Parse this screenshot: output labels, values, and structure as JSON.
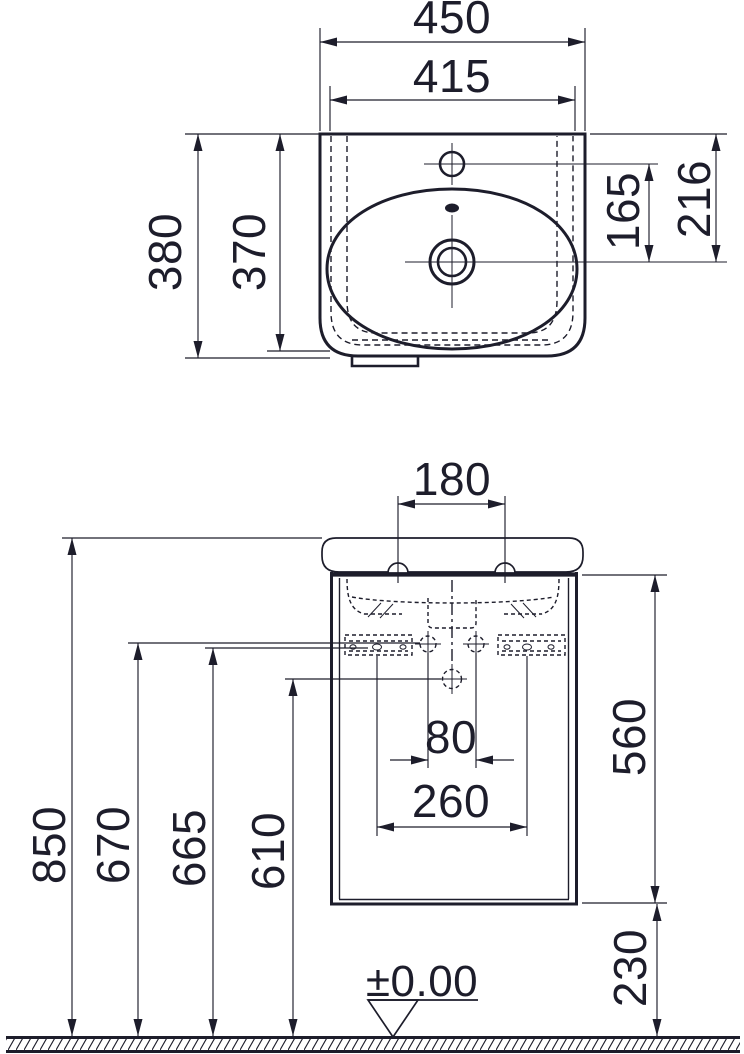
{
  "drawing": {
    "type": "technical-installation-drawing",
    "subject": "wall-hung washbasin with cabinet, plan view and front elevation",
    "line_color": "#1d1d2b",
    "background_color": "#ffffff"
  },
  "top_view": {
    "dims": {
      "overall_width": "450",
      "ledge_width": "415",
      "overall_depth": "380",
      "inner_depth": "370",
      "tap_to_drain": "165",
      "rear_to_drain": "216"
    },
    "features": [
      "basin-outline",
      "hidden-edge-dashed-contours",
      "inner-bowl",
      "tap-hole",
      "overflow-hole",
      "drain-hole",
      "rear-mounting-tab"
    ]
  },
  "front_view": {
    "dims": {
      "tap_hole_spacing": "180",
      "fixing_hole_spacing": "80",
      "bracket_hole_spacing": "260",
      "rim_height": "850",
      "bracket_height": "670",
      "fixing_hole_height": "665",
      "lower_fixing_height": "610",
      "cabinet_height": "560",
      "floor_clearance": "230",
      "floor_level": "±0.00"
    },
    "features": [
      "basin-profile",
      "mounting-bolts",
      "cabinet",
      "hidden-basin-underside",
      "wall-brackets",
      "fixing-crosshair-holes",
      "floor-hatch",
      "floor-level-marker"
    ]
  }
}
